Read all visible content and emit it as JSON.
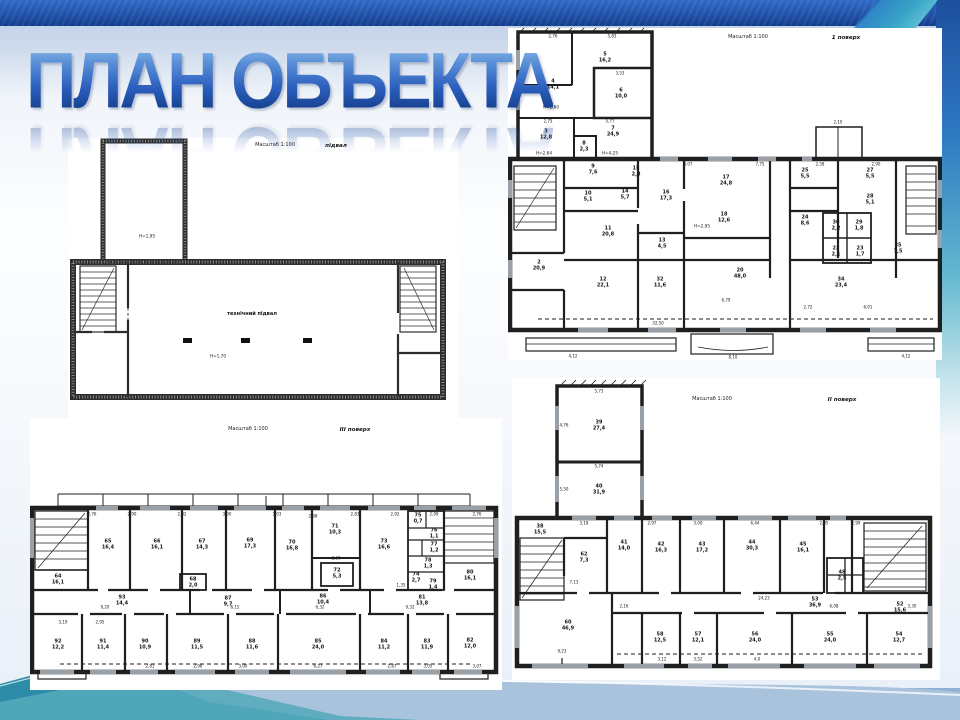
{
  "slide": {
    "title": "ПЛАН ОБЪЕКТА"
  },
  "plans": {
    "basement": {
      "scale": "Масштаб 1:100",
      "name": "підвал",
      "room": "технічний підвал",
      "h1": "Н=1,95",
      "h2": "Н=1,70"
    },
    "floor1": {
      "scale": "Масштаб 1:100",
      "name": "1 поверх",
      "rooms": [
        "4\n14,1",
        "5\n16,2",
        "6\n10,0",
        "3\n12,8",
        "8\n2,3",
        "7\n24,9",
        "9\n7,6",
        "15\n2,8",
        "10\n5,1",
        "14\n5,7",
        "11\n20,8",
        "16\n17,3",
        "17\n24,8",
        "13\n4,5",
        "18\n12,6",
        "2\n20,9",
        "12\n22,1",
        "32\n11,6",
        "20\n48,0",
        "34\n23,4",
        "25\n5,5",
        "27\n5,5",
        "28\n5,1",
        "24\n8,6",
        "30\n2,2",
        "29\n1,8",
        "22\n2,1",
        "23\n1,7",
        "35\n7,5"
      ],
      "heights": [
        "Н=2,60",
        "Н=2,64",
        "Н=4,25",
        "Н=2,95"
      ],
      "dims": [
        "2,76",
        "5,83",
        "3,53",
        "2,75",
        "5,77",
        "3,07",
        "7,75",
        "2,58",
        "2,90",
        "2,10",
        "32,50",
        "8,10",
        "4,12",
        "4,12",
        "2,72",
        "6,01",
        "6,79"
      ]
    },
    "floor3": {
      "scale": "Масштаб 1:100",
      "name": "III поверх",
      "rooms": [
        "64\n16,1",
        "65\n16,4",
        "66\n16,1",
        "67\n14,3",
        "68\n2,0",
        "69\n17,3",
        "70\n16,8",
        "71\n10,3",
        "72\n5,3",
        "73\n16,6",
        "75\n0,7",
        "76\n1,1",
        "77\n1,2",
        "78\n1,3",
        "74\n2,7",
        "79\n1,4",
        "80\n16,1",
        "93\n14,4",
        "87\n9,7",
        "86\n10,4",
        "81\n13,8",
        "92\n12,2",
        "91\n11,4",
        "90\n10,9",
        "89\n11,5",
        "88\n11,6",
        "85\n24,0",
        "84\n11,2",
        "83\n11,9",
        "82\n12,0"
      ],
      "dims": [
        "2,76",
        "2,90",
        "2,82",
        "3,00",
        "3,03",
        "2,98",
        "2,83",
        "2,92",
        "2,99",
        "2,76",
        "9,20",
        "6,15",
        "6,32",
        "9,32",
        "3,19",
        "2,95",
        "2,81",
        "2,98",
        "3,00",
        "6,27",
        "2,87",
        "3,05",
        "3,07",
        "2,60",
        "1,35"
      ]
    },
    "floor2": {
      "scale": "Масштаб 1:100",
      "name": "II поверх",
      "rooms": [
        "39\n27,4",
        "40\n31,9",
        "38\n15,5",
        "62\n7,3",
        "41\n14,0",
        "42\n16,3",
        "43\n17,2",
        "44\n30,3",
        "45\n16,1",
        "48\n2,5",
        "52\n15,6",
        "53\n36,9",
        "60\n46,9",
        "58\n12,5",
        "57\n12,1",
        "56\n24,0",
        "55\n24,0",
        "54\n12,7"
      ],
      "dims": [
        "5,73",
        "4,76",
        "5,74",
        "5,50",
        "3,18",
        "2,97",
        "3,00",
        "6,44",
        "2,95",
        "2,99",
        "24,23",
        "2,16",
        "6,08",
        "3,30",
        "9,23",
        "3,12",
        "3,52",
        "4,0",
        "7,13"
      ]
    }
  }
}
